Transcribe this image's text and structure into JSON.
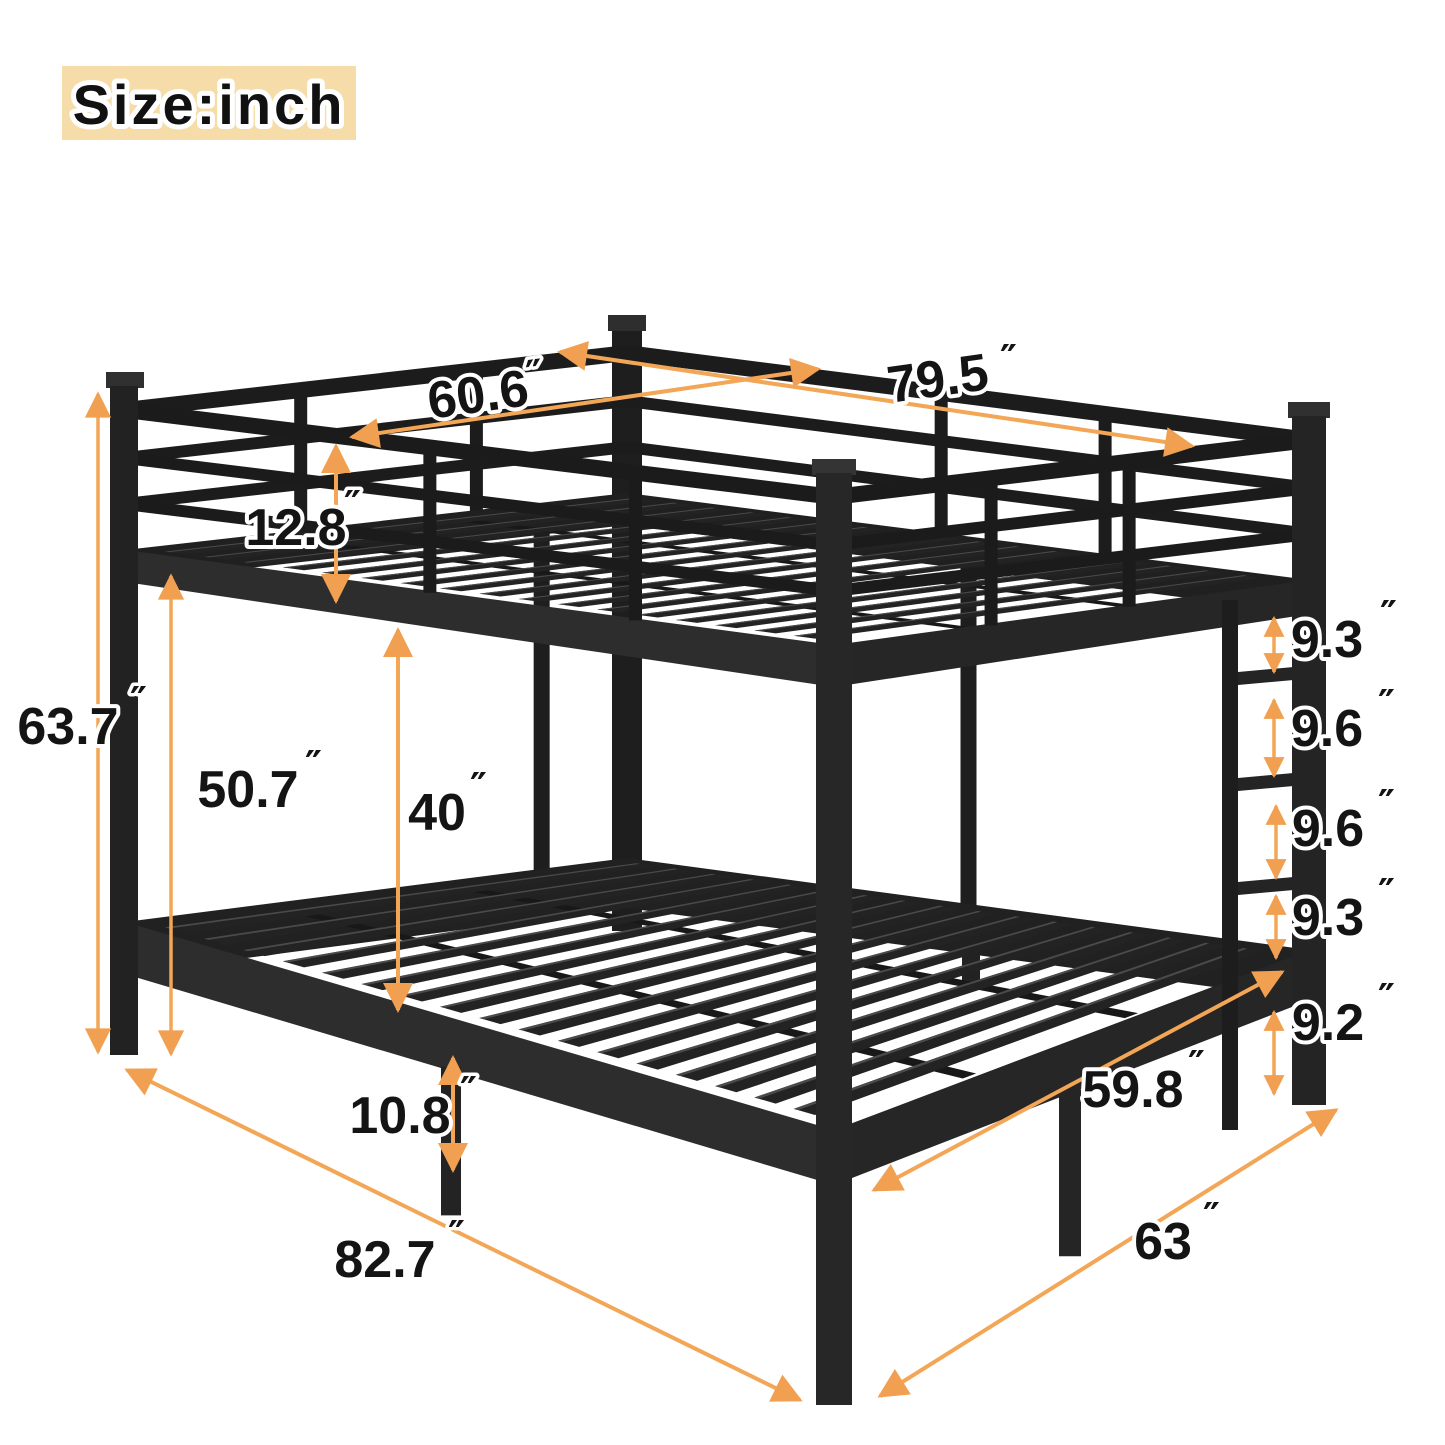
{
  "badge": {
    "label": "Size:inch"
  },
  "inch_mark": "″",
  "dimensions": {
    "upper_bed_width": "60.6",
    "upper_bed_length": "79.5",
    "guardrail_height": "12.8",
    "overall_height": "63.7",
    "under_upper_bunk_height": "50.7",
    "bunk_clearance": "40",
    "ladder_step_gap_1": "9.3",
    "ladder_step_gap_2": "9.6",
    "ladder_step_gap_3": "9.6",
    "ladder_step_gap_4": "9.3",
    "ladder_bottom_gap": "9.2",
    "lower_leg_height": "10.8",
    "lower_bed_width": "59.8",
    "overall_length": "82.7",
    "overall_width": "63"
  },
  "colors": {
    "dimension_arrow": "#F2A656",
    "arrowhead": "#F0A050",
    "badge_background": "#F6DCA8",
    "bed_frame": "#1F1F1F",
    "label_text": "#141414"
  }
}
